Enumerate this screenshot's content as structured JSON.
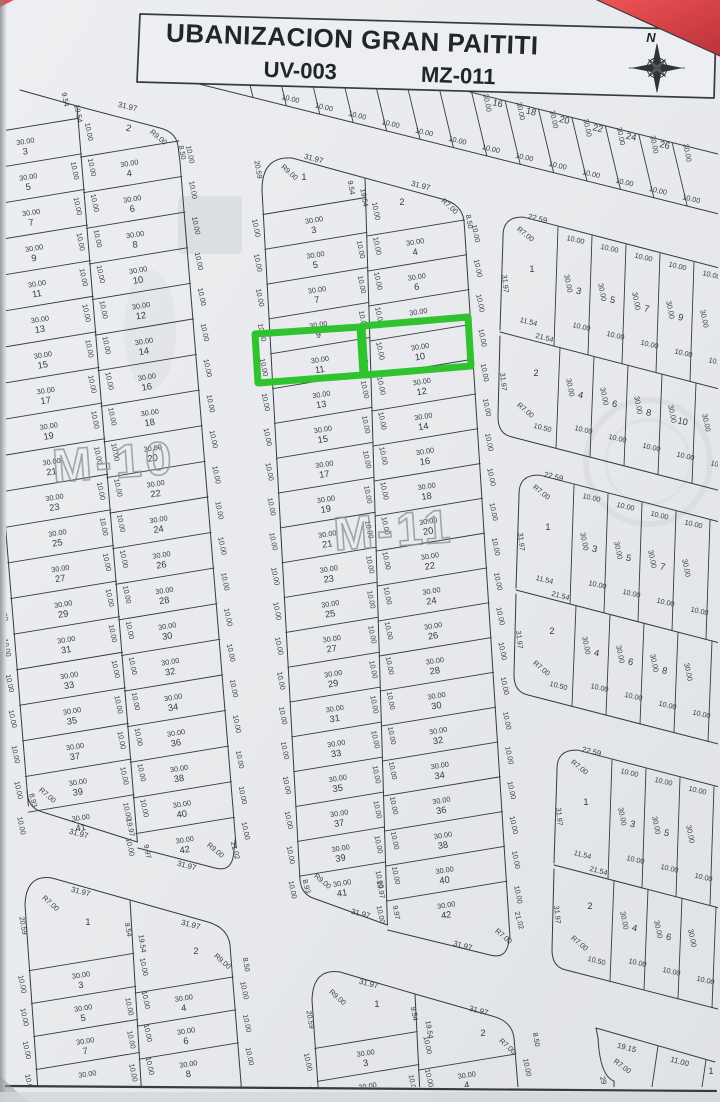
{
  "title": {
    "line1": "UBANIZACION GRAN PAITITI",
    "uv": "UV-003",
    "mz": "MZ-011",
    "compass": "N"
  },
  "dims": {
    "lot_width": "30.00",
    "lot_depth": "10.00"
  },
  "highlight": {
    "color": "#2fc42f",
    "lots": [
      "11",
      "10"
    ]
  },
  "watermarks": {
    "m10": "M-10",
    "m11": "M-11"
  },
  "strip": {
    "numbers": [
      "16",
      "18",
      "20",
      "22",
      "24",
      "26"
    ],
    "depth": "30.00",
    "width": "10.00"
  },
  "m10": {
    "header": {
      "spine_a": "9.54",
      "spine_b": "19.54",
      "lot2": "2",
      "lot2_front": "31.97",
      "lot2_radius": "R9.00",
      "lot2_side": "8.50"
    },
    "left_numbers": [
      "3",
      "5",
      "7",
      "9",
      "11",
      "13",
      "15",
      "17",
      "19",
      "21",
      "23",
      "25",
      "27",
      "29",
      "31",
      "33",
      "35",
      "37",
      "39",
      "41"
    ],
    "right_numbers": [
      "4",
      "6",
      "8",
      "10",
      "12",
      "14",
      "16",
      "18",
      "20",
      "22",
      "24",
      "26",
      "28",
      "30",
      "32",
      "34",
      "36",
      "38",
      "40",
      "42"
    ],
    "footer": {
      "left_side": "8.93",
      "left_radius": "R7.00",
      "left_front": "31.97",
      "spine_a": "19.97",
      "spine_b": "9.97",
      "right_front": "31.97",
      "right_radius": "R9.00",
      "right_side": "21.02"
    }
  },
  "m11": {
    "header": {
      "lot1": "1",
      "lot1_front": "31.97",
      "lot1_radius": "R9.00",
      "lot1_side": "20.59",
      "spine_a": "9.54",
      "spine_b": "19.54",
      "lot2": "2",
      "lot2_front": "31.97",
      "lot2_radius": "R7.00",
      "lot2_side": "8.50"
    },
    "left_numbers": [
      "3",
      "5",
      "7",
      "9",
      "11",
      "13",
      "15",
      "17",
      "19",
      "21",
      "23",
      "25",
      "27",
      "29",
      "31",
      "33",
      "35",
      "37",
      "39",
      "41"
    ],
    "right_numbers": [
      "4",
      "6",
      "8",
      "10",
      "12",
      "14",
      "16",
      "18",
      "20",
      "22",
      "24",
      "26",
      "28",
      "30",
      "32",
      "34",
      "36",
      "38",
      "40",
      "42"
    ],
    "footer": {
      "left_side": "8.93",
      "left_radius": "R9.00",
      "left_front": "31.97",
      "spine_a": "19.97",
      "spine_b": "9.97",
      "right_front": "31.97",
      "right_radius": "R7.00",
      "right_side": "21.02"
    }
  },
  "bl": {
    "header": {
      "lot1": "1",
      "lot1_front": "31.97",
      "lot1_radius": "R7.00",
      "lot1_side": "20.59",
      "spine_a": "9.54",
      "spine_b": "19.54",
      "lot2": "2",
      "lot2_front": "31.97",
      "lot2_radius": "R9.00",
      "lot2_side": "8.50"
    },
    "left_numbers": [
      "3",
      "5",
      "7"
    ],
    "right_numbers": [
      "4",
      "6",
      "8"
    ]
  },
  "bm": {
    "header": {
      "lot1": "1",
      "lot1_front": "31.97",
      "lot1_radius": "R9.00",
      "lot1_side": "20.59",
      "spine_a": "9.54",
      "spine_b": "19.54",
      "lot2": "2",
      "lot2_front": "31.97",
      "lot2_radius": "R7.00",
      "lot2_side": "8.50"
    },
    "left_numbers": [
      "3"
    ],
    "right_numbers": [
      "4"
    ]
  },
  "right_blocks": [
    {
      "corner_top": "22.59",
      "corner_radius": "R7.00",
      "corner_side": "31.97",
      "lot1": "1",
      "mid_a": "11.54",
      "mid_b": "21.54",
      "lot2": "2",
      "lot2_side": "31.97",
      "lot2_radius": "R7.00",
      "bottom_left": "10.50",
      "row_a": [
        "3",
        "5",
        "7",
        "9"
      ],
      "row_b": [
        "4",
        "6",
        "8",
        "10"
      ]
    },
    {
      "corner_top": "22.59",
      "corner_radius": "R7.00",
      "corner_side": "31.97",
      "lot1": "1",
      "mid_a": "11.54",
      "mid_b": "21.54",
      "lot2": "2",
      "lot2_side": "31.97",
      "lot2_radius": "R7.00",
      "bottom_left": "10.50",
      "row_a": [
        "3",
        "5",
        "7"
      ],
      "row_b": [
        "4",
        "6",
        "8"
      ]
    },
    {
      "corner_top": "22.59",
      "corner_radius": "R7.00",
      "corner_side": "31.97",
      "lot1": "1",
      "mid_a": "11.54",
      "mid_b": "21.54",
      "lot2": "2",
      "lot2_side": "31.97",
      "lot2_radius": "R7.00",
      "bottom_left": "10.50",
      "row_a": [
        "3",
        "5"
      ],
      "row_b": [
        "4",
        "6"
      ]
    }
  ],
  "br_corner": {
    "front_a": "19.15",
    "radius": "R7.00",
    "side": "29",
    "front_b": "11.00",
    "partial": "1"
  }
}
